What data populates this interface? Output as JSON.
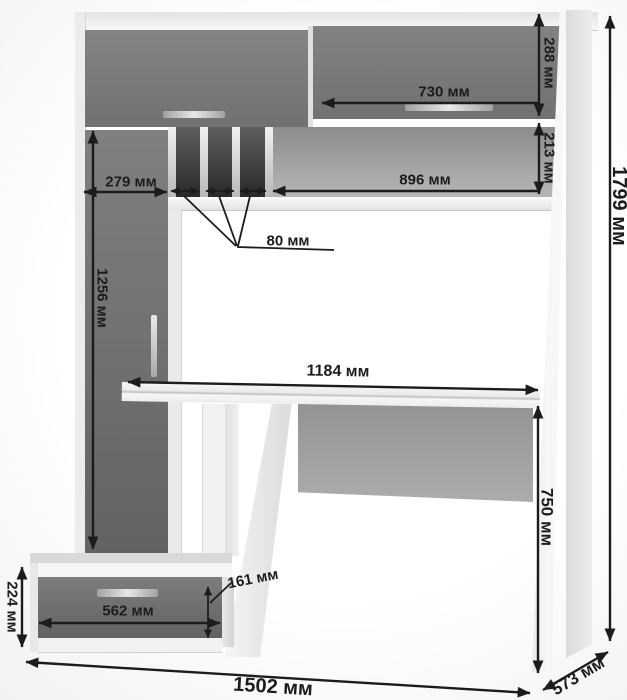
{
  "drawing": {
    "type": "furniture-dimension-diagram",
    "subject": "Computer desk with hutch, tall cabinet and drawer pedestal",
    "unit": "мм",
    "dims": {
      "d288": {
        "label": "288 мм",
        "value": 288
      },
      "d730": {
        "label": "730 мм",
        "value": 730
      },
      "d213": {
        "label": "213 мм",
        "value": 213
      },
      "d896": {
        "label": "896 мм",
        "value": 896
      },
      "d279": {
        "label": "279 мм",
        "value": 279
      },
      "d80": {
        "label": "80 мм",
        "value": 80
      },
      "d1256": {
        "label": "1256 мм",
        "value": 1256
      },
      "d1184": {
        "label": "1184 мм",
        "value": 1184
      },
      "d750": {
        "label": "750 мм",
        "value": 750
      },
      "d224": {
        "label": "224 мм",
        "value": 224
      },
      "d562": {
        "label": "562 мм",
        "value": 562
      },
      "d161": {
        "label": "161 мм",
        "value": 161
      },
      "d1502": {
        "label": "1502 мм",
        "value": 1502
      },
      "d573": {
        "label": "573 мм",
        "value": 573
      },
      "d1799": {
        "label": "1799 мм",
        "value": 1799
      }
    },
    "colors": {
      "line": "#1b1c1d",
      "door_gray": "#737577",
      "panel_white": "#f3f4f6",
      "back_panel_gray": "#9fa1a3",
      "slot_dark": "#2c2d2f"
    }
  }
}
